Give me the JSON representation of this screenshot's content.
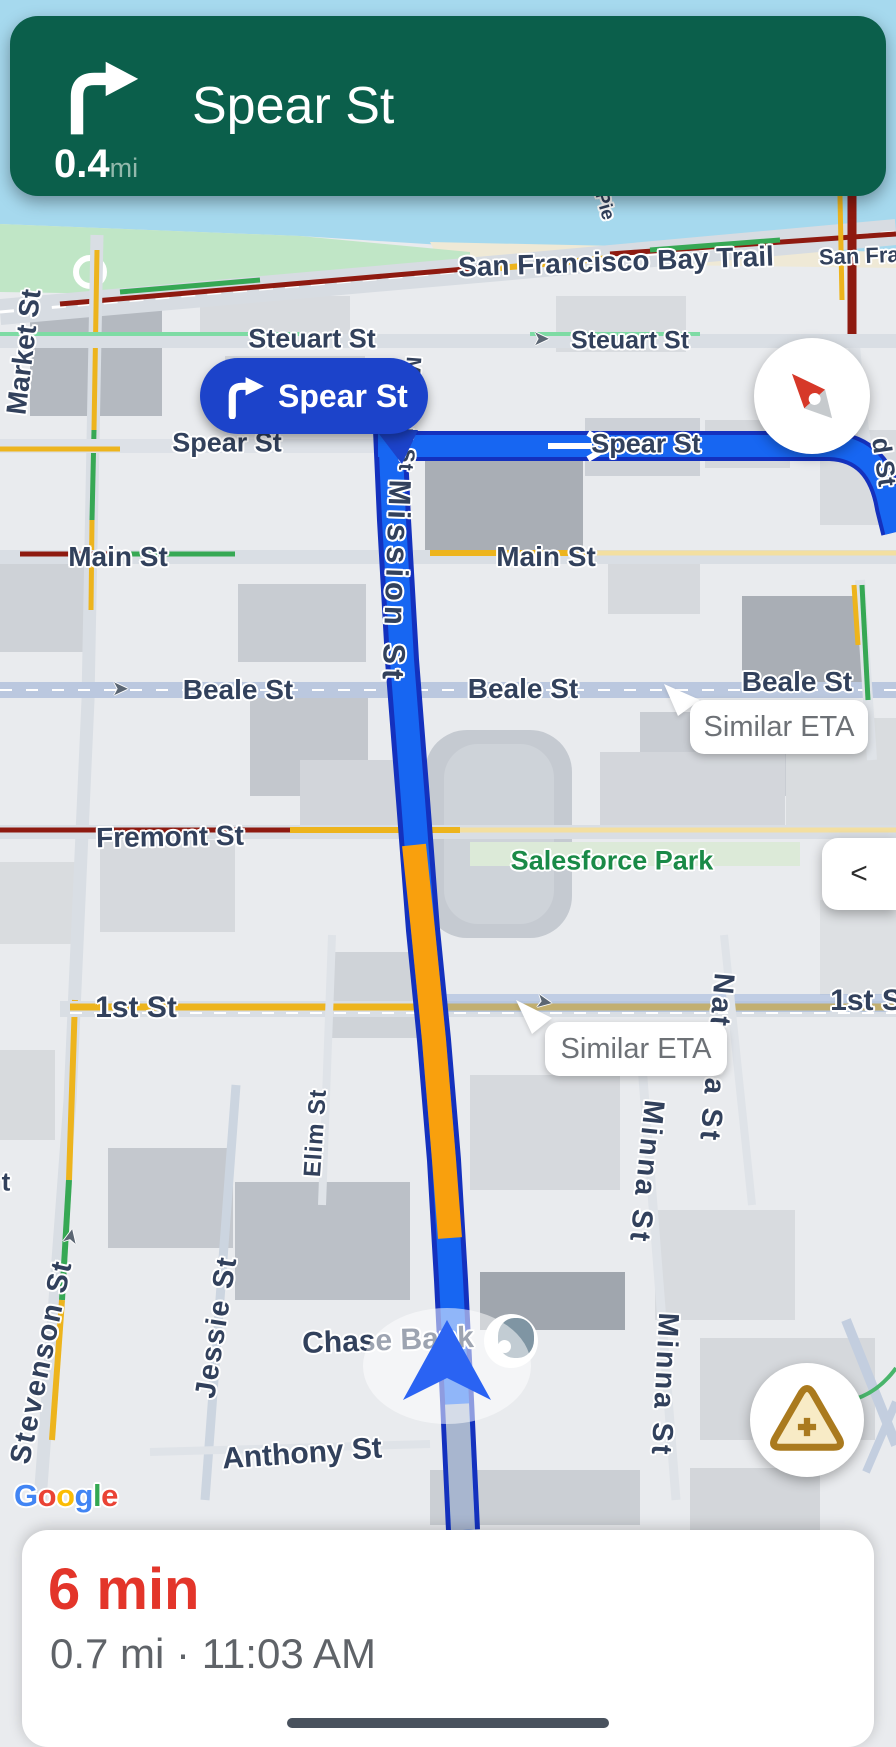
{
  "nav_banner": {
    "next_street": "Spear St",
    "distance": "0.4",
    "distance_unit": "mi",
    "maneuver": "turn-right"
  },
  "turn_callout": {
    "street": "Spear St",
    "maneuver": "turn-right"
  },
  "eta_bubbles": [
    {
      "label": "Similar ETA"
    },
    {
      "label": "Similar ETA"
    }
  ],
  "controls": {
    "collapse": "<",
    "compass_icon": "compass-needle",
    "report_icon": "warning-triangle-plus",
    "voice_icon": "speaker",
    "puck_icon": "nav-chevron"
  },
  "bottom_sheet": {
    "eta": "6 min",
    "trip_details": "0.7 mi · 11:03 AM"
  },
  "map": {
    "attribution": {
      "text": "Google",
      "letters": [
        "G",
        "o",
        "o",
        "g",
        "l",
        "e"
      ],
      "letter_colors": [
        "#4285F4",
        "#EA4335",
        "#FBBC05",
        "#4285F4",
        "#34A853",
        "#EA4335"
      ]
    },
    "labels": [
      {
        "text": "Pie",
        "x": 604,
        "y": 206,
        "rot": 74,
        "size": 19,
        "cls": "navy"
      },
      {
        "text": "San Francisco Bay Trail",
        "x": 616,
        "y": 262,
        "rot": -2,
        "size": 28,
        "cls": "navy"
      },
      {
        "text": "San Fran",
        "x": 866,
        "y": 256,
        "rot": -2,
        "size": 22,
        "cls": "navy"
      },
      {
        "text": "Market St",
        "x": 24,
        "y": 352,
        "rot": -83,
        "size": 28,
        "cls": "navy"
      },
      {
        "text": "Steuart St",
        "x": 312,
        "y": 339,
        "rot": 0,
        "size": 27,
        "cls": "navy"
      },
      {
        "text": "Steuart St",
        "x": 630,
        "y": 341,
        "rot": 0,
        "size": 25,
        "cls": "navy"
      },
      {
        "text": "Spear St",
        "x": 227,
        "y": 443,
        "rot": 0,
        "size": 27,
        "cls": "navy"
      },
      {
        "text": "Spear St",
        "x": 646,
        "y": 444,
        "rot": 0,
        "size": 27,
        "cls": "navy"
      },
      {
        "text": "Main St",
        "x": 118,
        "y": 557,
        "rot": 0,
        "size": 28,
        "cls": "navy"
      },
      {
        "text": "Main St",
        "x": 546,
        "y": 557,
        "rot": 0,
        "size": 28,
        "cls": "navy"
      },
      {
        "text": "Mission St",
        "x": 409,
        "y": 414,
        "rot": 94,
        "size": 21,
        "ls": 1,
        "cls": "navy"
      },
      {
        "text": "Mission St",
        "x": 396,
        "y": 582,
        "rot": 92,
        "size": 31,
        "ls": 5,
        "cls": "navy"
      },
      {
        "text": "Beale St",
        "x": 238,
        "y": 690,
        "rot": 0,
        "size": 28,
        "cls": "navy"
      },
      {
        "text": "Beale St",
        "x": 523,
        "y": 689,
        "rot": 0,
        "size": 28,
        "cls": "navy"
      },
      {
        "text": "Beale St",
        "x": 797,
        "y": 682,
        "rot": 0,
        "size": 28,
        "cls": "navy"
      },
      {
        "text": "Fremont St",
        "x": 170,
        "y": 837,
        "rot": -1,
        "size": 28,
        "cls": "navy"
      },
      {
        "text": "Salesforce Park",
        "x": 612,
        "y": 861,
        "rot": 0,
        "size": 27,
        "cls": "green"
      },
      {
        "text": "1st St",
        "x": 136,
        "y": 1008,
        "rot": 0,
        "size": 30,
        "cls": "navy"
      },
      {
        "text": "1st S",
        "x": 866,
        "y": 1001,
        "rot": 0,
        "size": 30,
        "cls": "navy"
      },
      {
        "text": "Natoma St",
        "x": 716,
        "y": 1058,
        "rot": 95,
        "size": 29,
        "ls": 3,
        "cls": "navy"
      },
      {
        "text": "Minna St",
        "x": 646,
        "y": 1172,
        "rot": 96,
        "size": 29,
        "ls": 3,
        "cls": "navy"
      },
      {
        "text": "Minna St",
        "x": 664,
        "y": 1385,
        "rot": 93,
        "size": 29,
        "ls": 3,
        "cls": "navy"
      },
      {
        "text": "Elim St",
        "x": 316,
        "y": 1133,
        "rot": -86,
        "size": 24,
        "ls": 1,
        "cls": "navy"
      },
      {
        "text": "Jessie St",
        "x": 217,
        "y": 1327,
        "rot": -81,
        "size": 29,
        "ls": 2,
        "cls": "navy"
      },
      {
        "text": "Stevenson St",
        "x": 42,
        "y": 1362,
        "rot": -78,
        "size": 29,
        "ls": 2,
        "cls": "navy"
      },
      {
        "text": "Chase Bank",
        "x": 388,
        "y": 1341,
        "rot": -2,
        "size": 30,
        "cls": "navy"
      },
      {
        "text": "Anthony St",
        "x": 302,
        "y": 1454,
        "rot": -4,
        "size": 30,
        "cls": "navy"
      },
      {
        "text": "d St",
        "x": 884,
        "y": 462,
        "rot": 82,
        "size": 26,
        "cls": "navy"
      },
      {
        "text": "t",
        "x": 6,
        "y": 1182,
        "rot": 0,
        "size": 26,
        "cls": "navy"
      }
    ],
    "route_arrows": [
      {
        "x": 533,
        "y": 338,
        "rot": 0
      },
      {
        "x": 536,
        "y": 1001,
        "rot": 10
      },
      {
        "x": 62,
        "y": 1236,
        "rot": -78
      },
      {
        "x": 112,
        "y": 688,
        "rot": 0
      }
    ],
    "colors": {
      "banner_green": "#0b5f4b",
      "callout_blue": "#1c43ca",
      "route_blue": "#1766f2",
      "route_border": "#1431be",
      "route_orange": "#f9a00d",
      "traveled_gray": "#a8b6cf",
      "alt_route": "#8ea8d8",
      "traffic_dark_red": "#8e1a10",
      "traffic_yellow": "#edb41d",
      "traffic_green": "#36a854",
      "water": "#a6d9ee",
      "park": "#c0e6c6",
      "eta_red": "#e3352a",
      "subtext_gray": "#5f6368",
      "label_navy": "#32415c",
      "label_green": "#1a8a47"
    }
  }
}
